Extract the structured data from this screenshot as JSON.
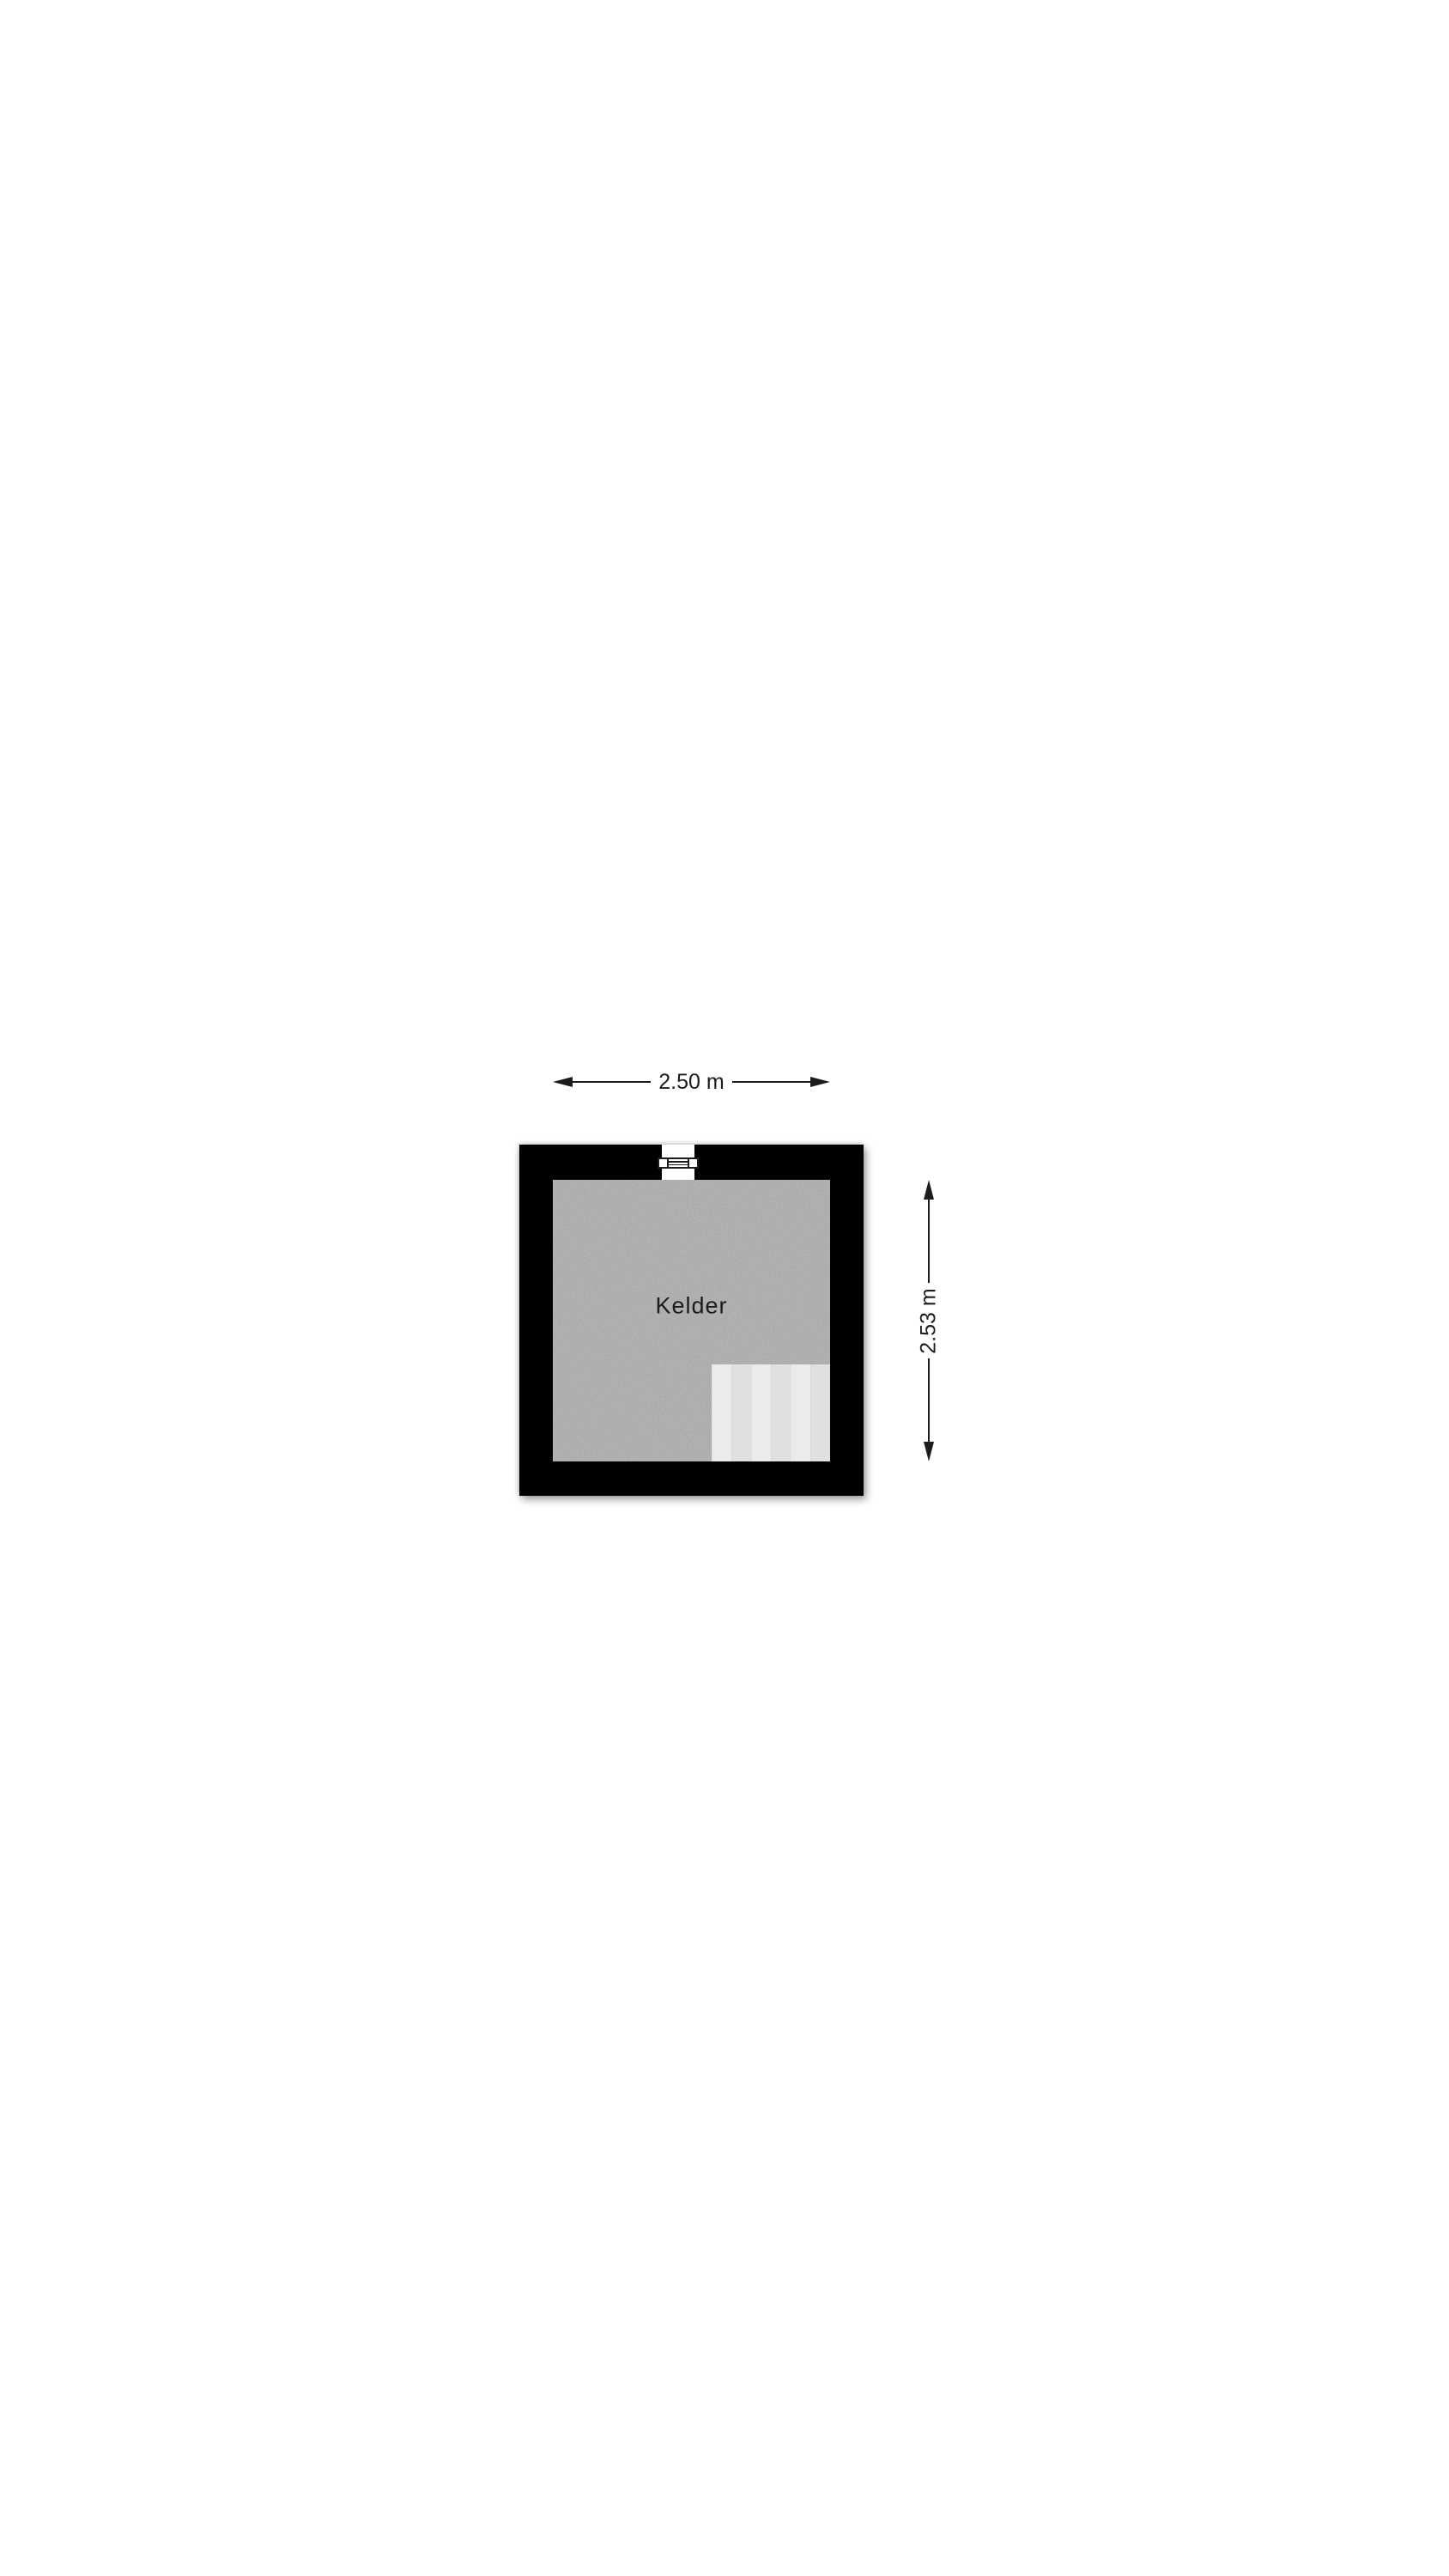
{
  "floorplan": {
    "room": {
      "label": "Kelder"
    },
    "dimensions": {
      "width": {
        "label": "2.50 m"
      },
      "height": {
        "label": "2.53 m"
      }
    },
    "features": {
      "window": "window-symbol-top-wall",
      "stairs": "stair-platform-bottom-right"
    },
    "colors": {
      "background": "#ffffff",
      "wall": "#000000",
      "floor": "#ababab",
      "stairs": "#e4e4e4",
      "text": "#1c1c1c"
    }
  }
}
